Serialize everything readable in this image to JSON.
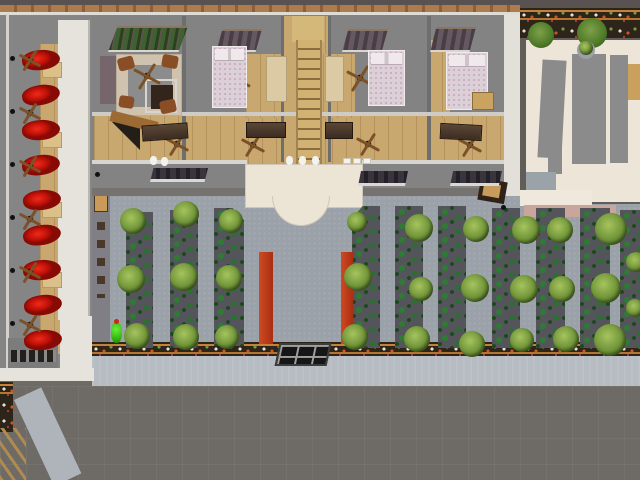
{
  "meta": {
    "scene": "aerial-3d-architectural-render",
    "view": "top-down",
    "canvas": {
      "width": 640,
      "height": 480
    }
  },
  "palette": {
    "road": "#6e6a66",
    "sidewalk": "#b6bcc2",
    "courtyard_path": "#9ba1a8",
    "building_floor": "#838383",
    "wood_floor": "#c9a870",
    "white_wall": "#e6e3dd",
    "canopy_cream": "#ece4d5",
    "red_seat": "#c01108",
    "red_planter": "#b5371c",
    "plant_green": "#2e7c33",
    "bush_olive": "#6f9338",
    "soil_strip": "#54555a",
    "flowerbed_soil": "#2e251a",
    "flowerbed_edge": "#c5803a",
    "neighbor_wall": "#ece5d8",
    "figure_green": "#2fae0e",
    "window_dark": "#4a3e46",
    "stair_wood": "#d2b273"
  },
  "counts": {
    "lounge_chairs": 9,
    "ceiling_fans": 14,
    "garden_strips": 10,
    "garden_bushes": 29,
    "street_trees": 2,
    "beds": 3,
    "desks": 4,
    "red_planters": 2
  },
  "sprites": [
    {
      "name": "garden-strip",
      "cls": "gstrip",
      "items": [
        {
          "x": 126,
          "y": 212,
          "w": 27,
          "h": 136
        },
        {
          "x": 170,
          "y": 210,
          "w": 28,
          "h": 138
        },
        {
          "x": 214,
          "y": 208,
          "w": 30,
          "h": 138,
          "cls2": "cut-r"
        },
        {
          "x": 352,
          "y": 206,
          "w": 28,
          "h": 142,
          "cls2": "cut-l"
        },
        {
          "x": 395,
          "y": 206,
          "w": 28,
          "h": 142
        },
        {
          "x": 438,
          "y": 206,
          "w": 28,
          "h": 142
        },
        {
          "x": 492,
          "y": 208,
          "w": 28,
          "h": 140
        },
        {
          "x": 536,
          "y": 208,
          "w": 29,
          "h": 140
        },
        {
          "x": 580,
          "y": 208,
          "w": 30,
          "h": 140
        },
        {
          "x": 620,
          "y": 210,
          "w": 20,
          "h": 138
        }
      ]
    },
    {
      "name": "red-planter-bench",
      "cls": "planter",
      "items": [
        {
          "x": 259,
          "y": 252,
          "w": 14,
          "h": 92
        },
        {
          "x": 341,
          "y": 252,
          "w": 12,
          "h": 92
        }
      ]
    },
    {
      "name": "garden-bush",
      "cls": "bush",
      "items": [
        {
          "x": 133,
          "y": 221,
          "r": 13
        },
        {
          "x": 131,
          "y": 279,
          "r": 14
        },
        {
          "x": 137,
          "y": 336,
          "r": 13
        },
        {
          "x": 186,
          "y": 214,
          "r": 13
        },
        {
          "x": 184,
          "y": 277,
          "r": 14
        },
        {
          "x": 186,
          "y": 337,
          "r": 13
        },
        {
          "x": 231,
          "y": 221,
          "r": 12
        },
        {
          "x": 229,
          "y": 278,
          "r": 13
        },
        {
          "x": 227,
          "y": 337,
          "r": 12
        },
        {
          "x": 357,
          "y": 222,
          "r": 10
        },
        {
          "x": 358,
          "y": 277,
          "r": 14
        },
        {
          "x": 355,
          "y": 337,
          "r": 13
        },
        {
          "x": 419,
          "y": 228,
          "r": 14
        },
        {
          "x": 421,
          "y": 289,
          "r": 12
        },
        {
          "x": 417,
          "y": 339,
          "r": 13
        },
        {
          "x": 476,
          "y": 229,
          "r": 13
        },
        {
          "x": 475,
          "y": 288,
          "r": 14
        },
        {
          "x": 472,
          "y": 344,
          "r": 13
        },
        {
          "x": 526,
          "y": 230,
          "r": 14
        },
        {
          "x": 524,
          "y": 289,
          "r": 14
        },
        {
          "x": 522,
          "y": 340,
          "r": 12
        },
        {
          "x": 560,
          "y": 230,
          "r": 13
        },
        {
          "x": 562,
          "y": 289,
          "r": 13
        },
        {
          "x": 566,
          "y": 339,
          "r": 13
        },
        {
          "x": 611,
          "y": 229,
          "r": 16
        },
        {
          "x": 606,
          "y": 288,
          "r": 15
        },
        {
          "x": 610,
          "y": 340,
          "r": 16
        },
        {
          "x": 636,
          "y": 262,
          "r": 10
        },
        {
          "x": 635,
          "y": 308,
          "r": 9
        }
      ]
    },
    {
      "name": "street-tree",
      "cls": "tree",
      "items": [
        {
          "x": 541,
          "y": 35,
          "r": 13
        },
        {
          "x": 592,
          "y": 33,
          "r": 15
        }
      ]
    },
    {
      "name": "topiary-base",
      "cls": "disc",
      "items": [
        {
          "x": 586,
          "y": 50,
          "r": 9
        }
      ]
    },
    {
      "name": "topiary-bush",
      "cls": "bush",
      "items": [
        {
          "x": 586,
          "y": 48,
          "r": 7
        }
      ]
    },
    {
      "name": "lounge-side-table",
      "cls": "ltable",
      "items": [
        {
          "x": 42,
          "y": 62,
          "w": 20,
          "h": 16
        },
        {
          "x": 42,
          "y": 132,
          "w": 20,
          "h": 16
        },
        {
          "x": 42,
          "y": 202,
          "w": 20,
          "h": 16
        },
        {
          "x": 42,
          "y": 272,
          "w": 20,
          "h": 16
        }
      ]
    },
    {
      "name": "lounge-red-chair",
      "cls": "red-chair",
      "items": [
        {
          "x": 22,
          "y": 50,
          "rot": -6
        },
        {
          "x": 22,
          "y": 85,
          "rot": -10
        },
        {
          "x": 22,
          "y": 120,
          "rot": -5
        },
        {
          "x": 22,
          "y": 155,
          "rot": -8
        },
        {
          "x": 23,
          "y": 190,
          "rot": -6
        },
        {
          "x": 23,
          "y": 225,
          "rot": -9
        },
        {
          "x": 23,
          "y": 260,
          "rot": -5
        },
        {
          "x": 24,
          "y": 295,
          "rot": -8
        },
        {
          "x": 24,
          "y": 330,
          "rot": -6
        }
      ]
    },
    {
      "name": "ceiling-fan",
      "cls": "fan",
      "items": [
        {
          "x": 18,
          "y": 48,
          "w": 24,
          "h": 24
        },
        {
          "x": 18,
          "y": 101,
          "w": 24,
          "h": 24
        },
        {
          "x": 18,
          "y": 154,
          "w": 24,
          "h": 24
        },
        {
          "x": 18,
          "y": 207,
          "w": 24,
          "h": 24
        },
        {
          "x": 18,
          "y": 260,
          "w": 24,
          "h": 24
        },
        {
          "x": 18,
          "y": 313,
          "w": 24,
          "h": 24
        },
        {
          "x": 132,
          "y": 61,
          "w": 30,
          "h": 30
        },
        {
          "x": 222,
          "y": 64,
          "w": 30,
          "h": 30
        },
        {
          "x": 345,
          "y": 63,
          "w": 30,
          "h": 30
        },
        {
          "x": 447,
          "y": 62,
          "w": 30,
          "h": 30
        },
        {
          "x": 164,
          "y": 131,
          "w": 26,
          "h": 26
        },
        {
          "x": 240,
          "y": 132,
          "w": 26,
          "h": 26
        },
        {
          "x": 355,
          "y": 131,
          "w": 26,
          "h": 26
        },
        {
          "x": 457,
          "y": 132,
          "w": 26,
          "h": 26
        }
      ]
    },
    {
      "name": "wall-lamp",
      "cls": "lamp",
      "items": [
        {
          "x": 10,
          "y": 56
        },
        {
          "x": 10,
          "y": 109
        },
        {
          "x": 10,
          "y": 162
        },
        {
          "x": 10,
          "y": 215
        },
        {
          "x": 10,
          "y": 268
        },
        {
          "x": 10,
          "y": 321
        },
        {
          "x": 95,
          "y": 172
        },
        {
          "x": 501,
          "y": 205
        }
      ]
    },
    {
      "name": "skylight-window-planted",
      "cls": "rwindow-green",
      "items": [
        {
          "x": 108,
          "y": 26,
          "w": 80,
          "h": 26
        }
      ]
    },
    {
      "name": "bedroom-window",
      "cls": "rwindow",
      "items": [
        {
          "x": 216,
          "y": 29,
          "w": 46,
          "h": 23
        },
        {
          "x": 342,
          "y": 29,
          "w": 46,
          "h": 23
        },
        {
          "x": 430,
          "y": 27,
          "w": 46,
          "h": 25
        }
      ]
    },
    {
      "name": "facade-window",
      "cls": "fwindow",
      "items": [
        {
          "x": 150,
          "y": 168,
          "w": 58,
          "h": 14
        },
        {
          "x": 358,
          "y": 171,
          "w": 50,
          "h": 15
        },
        {
          "x": 450,
          "y": 171,
          "w": 52,
          "h": 15
        }
      ]
    },
    {
      "name": "bedroom-bed",
      "cls": "bed",
      "items": [
        {
          "x": 212,
          "y": 46,
          "w": 35,
          "h": 62
        },
        {
          "x": 368,
          "y": 50,
          "w": 37,
          "h": 56
        },
        {
          "x": 446,
          "y": 52,
          "w": 42,
          "h": 58
        }
      ]
    },
    {
      "name": "study-desk",
      "cls": "desk",
      "items": [
        {
          "x": 142,
          "y": 124,
          "w": 46,
          "h": 16,
          "rot": -4
        },
        {
          "x": 246,
          "y": 122,
          "w": 40,
          "h": 16
        },
        {
          "x": 325,
          "y": 122,
          "w": 28,
          "h": 17
        },
        {
          "x": 440,
          "y": 124,
          "w": 42,
          "h": 16,
          "rot": 3
        }
      ]
    },
    {
      "name": "dining-table",
      "cls": "btable",
      "items": [
        {
          "x": 266,
          "y": 56,
          "w": 21,
          "h": 46
        },
        {
          "x": 325,
          "y": 56,
          "w": 19,
          "h": 46
        }
      ]
    },
    {
      "name": "armchair",
      "cls": "armchair",
      "items": [
        {
          "x": 118,
          "y": 57,
          "w": 16,
          "h": 13,
          "rot": -15
        },
        {
          "x": 162,
          "y": 55,
          "w": 16,
          "h": 13,
          "rot": 10
        },
        {
          "x": 119,
          "y": 96,
          "w": 15,
          "h": 12,
          "rot": 8
        },
        {
          "x": 160,
          "y": 100,
          "w": 16,
          "h": 13,
          "rot": -12
        }
      ]
    },
    {
      "name": "bath-fixture",
      "cls": "wfix",
      "items": [
        {
          "x": 150,
          "y": 156
        },
        {
          "x": 161,
          "y": 157
        },
        {
          "x": 286,
          "y": 156
        },
        {
          "x": 299,
          "y": 156
        },
        {
          "x": 312,
          "y": 156
        }
      ]
    },
    {
      "name": "roof-vent",
      "cls": "vent",
      "items": [
        {
          "x": 343,
          "y": 158,
          "w": 8,
          "h": 6
        },
        {
          "x": 353,
          "y": 158,
          "w": 8,
          "h": 6
        },
        {
          "x": 363,
          "y": 158,
          "w": 8,
          "h": 6
        }
      ]
    },
    {
      "name": "closet",
      "cls": "closet",
      "items": [
        {
          "x": 472,
          "y": 92,
          "w": 22,
          "h": 18
        }
      ]
    }
  ]
}
